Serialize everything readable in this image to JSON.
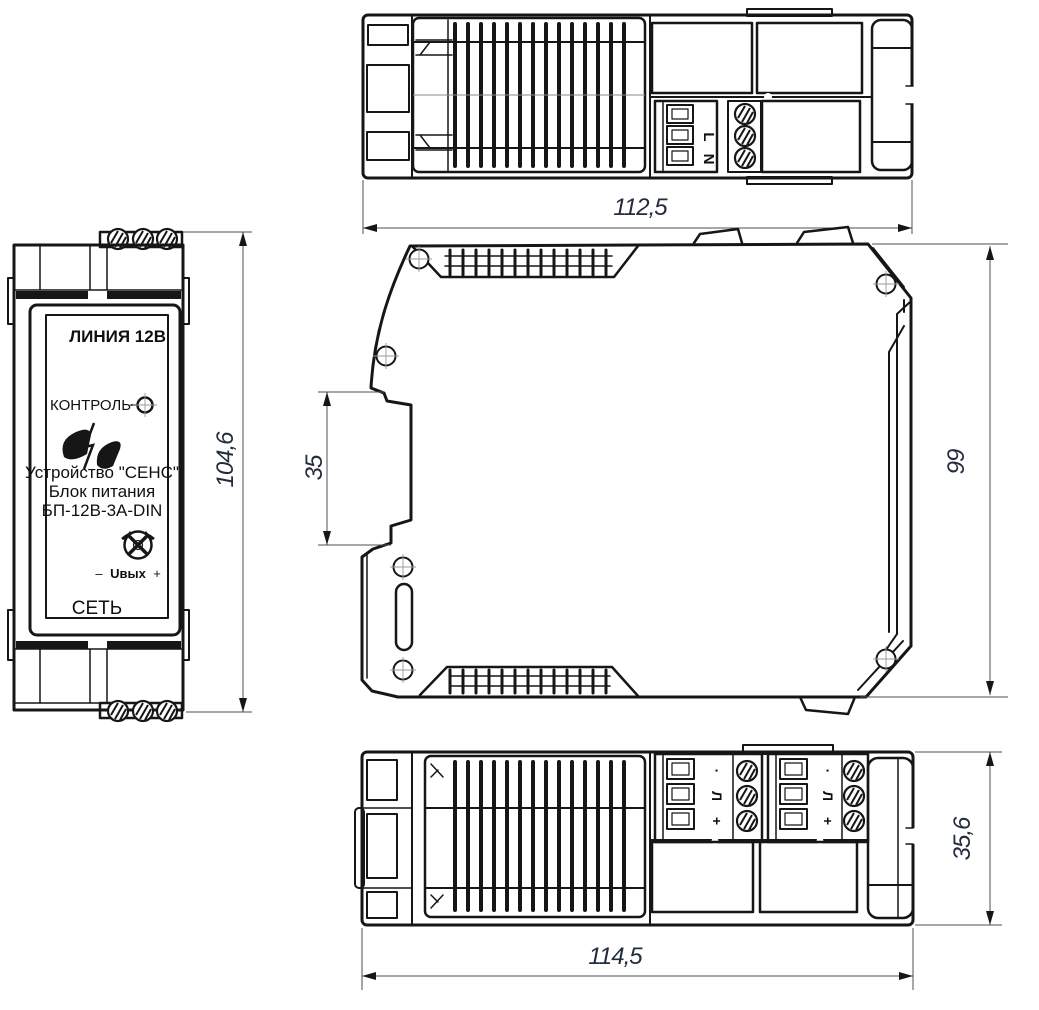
{
  "colors": {
    "line": "#161616",
    "dimension_text": "#232d3d",
    "background": "#ffffff"
  },
  "front_view": {
    "line_label": "ЛИНИЯ 12В",
    "control_label": "КОНТРОЛЬ",
    "device_line1": "Устройство \"СЕНС\"",
    "device_line2": "Блок питания",
    "device_line3": "БП-12В-3А-DIN",
    "uout_minus": "–",
    "uout_label": "Uвых",
    "uout_plus": "+",
    "net_label": "СЕТЬ",
    "dim_height": "104,6"
  },
  "top_view": {
    "terminal_l": "L",
    "terminal_n": "N",
    "dim_width": "112,5"
  },
  "side_view": {
    "dim_din_rail": "35",
    "dim_height": "99"
  },
  "bottom_view": {
    "terminal_dot": "·",
    "terminal_line": "Л",
    "terminal_plus": "+",
    "dim_depth": "35,6",
    "dim_width": "114,5"
  }
}
